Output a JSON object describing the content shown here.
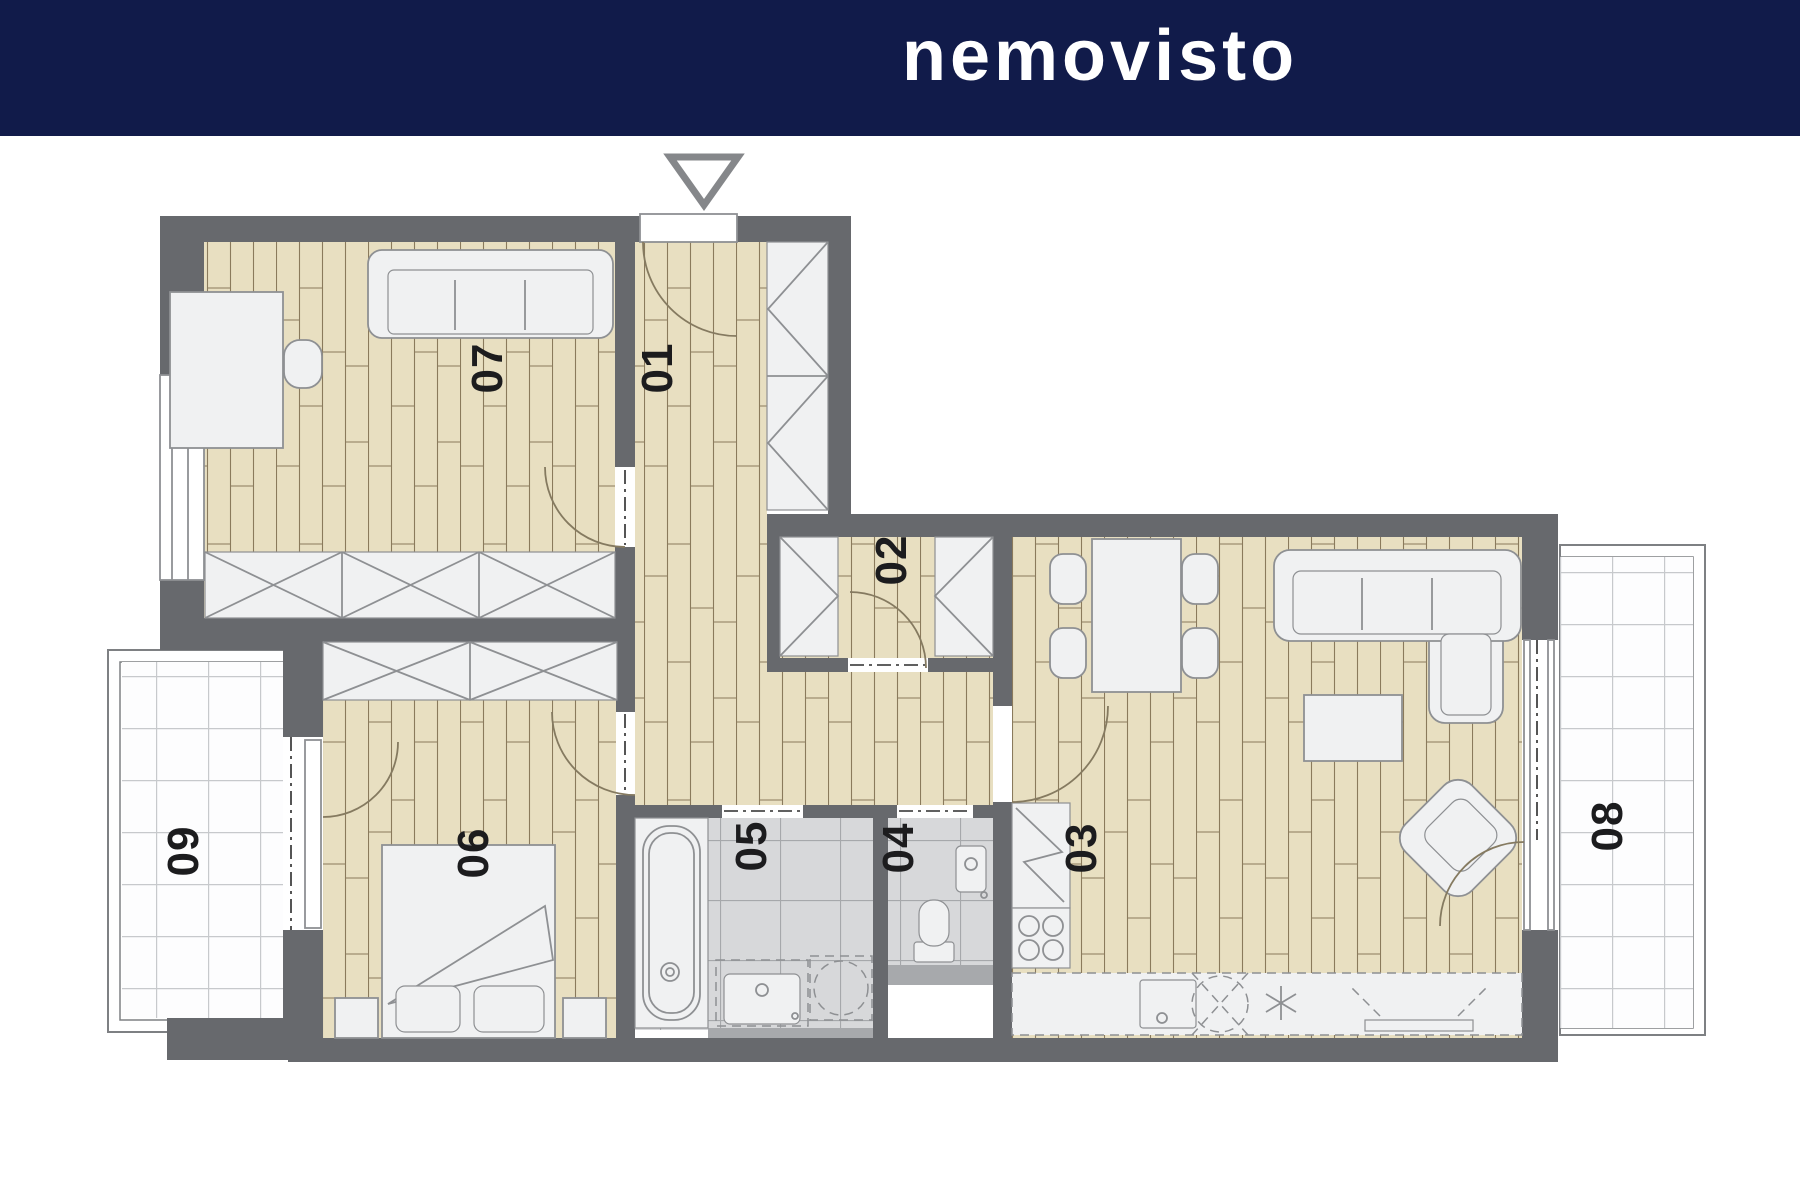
{
  "header": {
    "logo_text": "nemovisto",
    "background_color": "#111b4a",
    "logo_color": "#ffffff"
  },
  "floor_plan": {
    "colors": {
      "wall": "#67696d",
      "wood_floor": "#e8dfc1",
      "wood_joint": "#8a7a5c",
      "bath_tile": "#d7d8da",
      "bath_tile_line": "#a6a8ab",
      "balcony_tile_line": "#c7c9cc",
      "furniture_fill": "#f0f1f2",
      "furniture_stroke": "#8e9093",
      "door_arc": "#857a60",
      "threshold": "#a7a9ac",
      "label_color": "#1c1c1e"
    },
    "entrance_icon": "triangle-down-entrance-marker",
    "rooms": [
      {
        "id": "room-01",
        "label": "01"
      },
      {
        "id": "room-02",
        "label": "02"
      },
      {
        "id": "room-03",
        "label": "03"
      },
      {
        "id": "room-04",
        "label": "04"
      },
      {
        "id": "room-05",
        "label": "05"
      },
      {
        "id": "room-06",
        "label": "06"
      },
      {
        "id": "room-07",
        "label": "07"
      },
      {
        "id": "room-08",
        "label": "08"
      },
      {
        "id": "room-09",
        "label": "09"
      }
    ]
  }
}
